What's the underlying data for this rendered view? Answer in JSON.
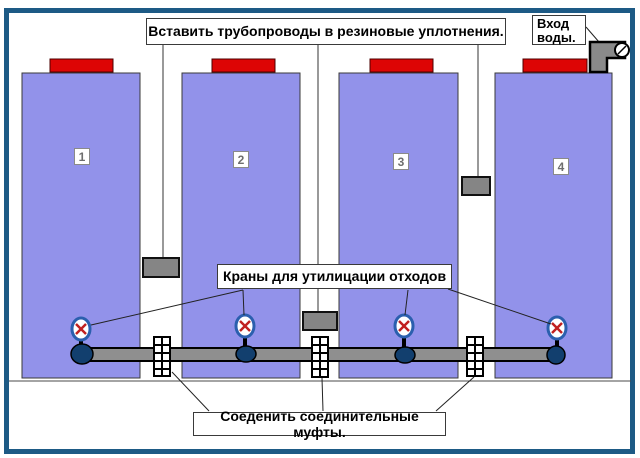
{
  "notes": {
    "top": "Вставить трубопроводы в резиновые уплотнения.",
    "water_inlet": {
      "line1": "Вход",
      "line2": "воды."
    },
    "valves": "Краны для утилицации отходов",
    "couplings": "Соеденить соединительные муфты."
  },
  "tanks": [
    {
      "label": "1"
    },
    {
      "label": "2"
    },
    {
      "label": "3"
    },
    {
      "label": "4"
    }
  ],
  "colors": {
    "frame_border": "#1d5a85",
    "tank_fill": "#9292ea",
    "cap_red": "#dd0505",
    "seal_gray": "#858585",
    "pipe_gray": "#8f8f8f",
    "joint_blue": "#123f6e",
    "valve_ring_blue": "#2b5fae",
    "valve_x_red": "#c02020"
  }
}
